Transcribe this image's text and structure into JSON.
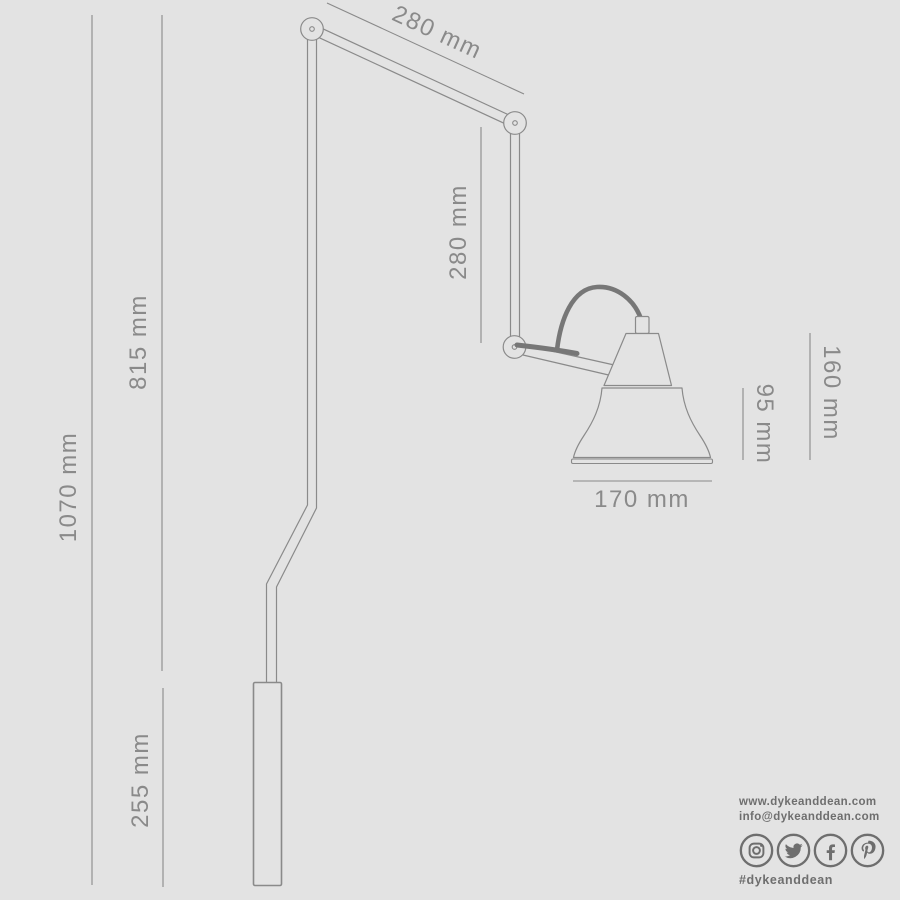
{
  "colors": {
    "background": "#e3e3e3",
    "line": "#8a8a8a",
    "cord": "#777777",
    "dimension_text": "#8a8a8a",
    "brand_text": "#6e6e6e"
  },
  "diagram": {
    "description": "articulated-wall-lamp-dimension-drawing",
    "dimensions": {
      "upper_arm": "280 mm",
      "forearm": "280 mm",
      "stem_drop": "815 mm",
      "overall_drop": "1070 mm",
      "wall_tube": "255 mm",
      "lamp_head_height": "160 mm",
      "shade_height": "95 mm",
      "shade_diameter": "170 mm"
    }
  },
  "branding": {
    "website": "www.dykeanddean.com",
    "email": "info@dykeanddean.com",
    "hashtag": "#dykeanddean",
    "social": [
      "instagram",
      "twitter",
      "facebook",
      "pinterest"
    ]
  }
}
